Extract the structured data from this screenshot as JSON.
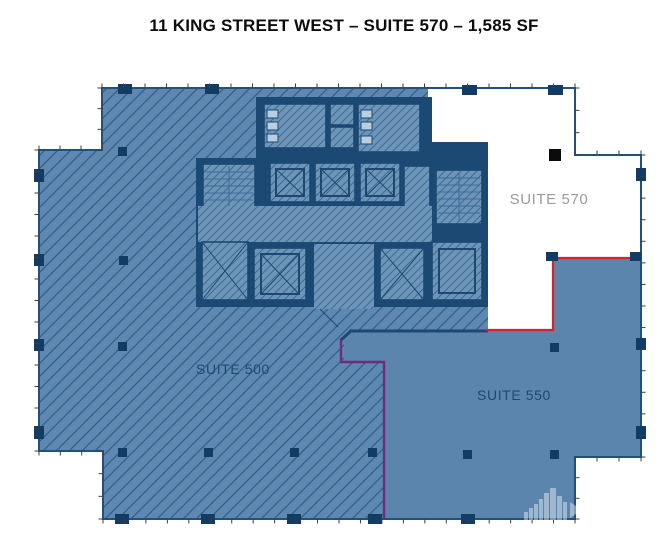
{
  "title": "11 KING STREET WEST – SUITE 570 – 1,585 SF",
  "plan": {
    "suite_500": {
      "label": "SUITE 500"
    },
    "suite_550": {
      "label": "SUITE 550"
    },
    "suite_570": {
      "label": "SUITE 570"
    }
  },
  "icons": {
    "watermark": "building-skyline-watermark"
  },
  "colors": {
    "floor_base": "#5e88b0",
    "hatch_line": "#2f608e",
    "core_navy": "#1b4973",
    "core_room": "#6e94b7",
    "core_hatch": "#3c6c98",
    "suite550_fill": "#5b85ad",
    "suite570_fill": "#ffffff",
    "boundary_red": "#d5232b",
    "boundary_purple": "#6f2b7e",
    "label_navy": "#1d4a74",
    "label_gray": "#9b9b9b",
    "column": "#123c63",
    "wall": "#24507c",
    "tick": "#3f3f3f",
    "title_color": "#0d0d0d"
  }
}
